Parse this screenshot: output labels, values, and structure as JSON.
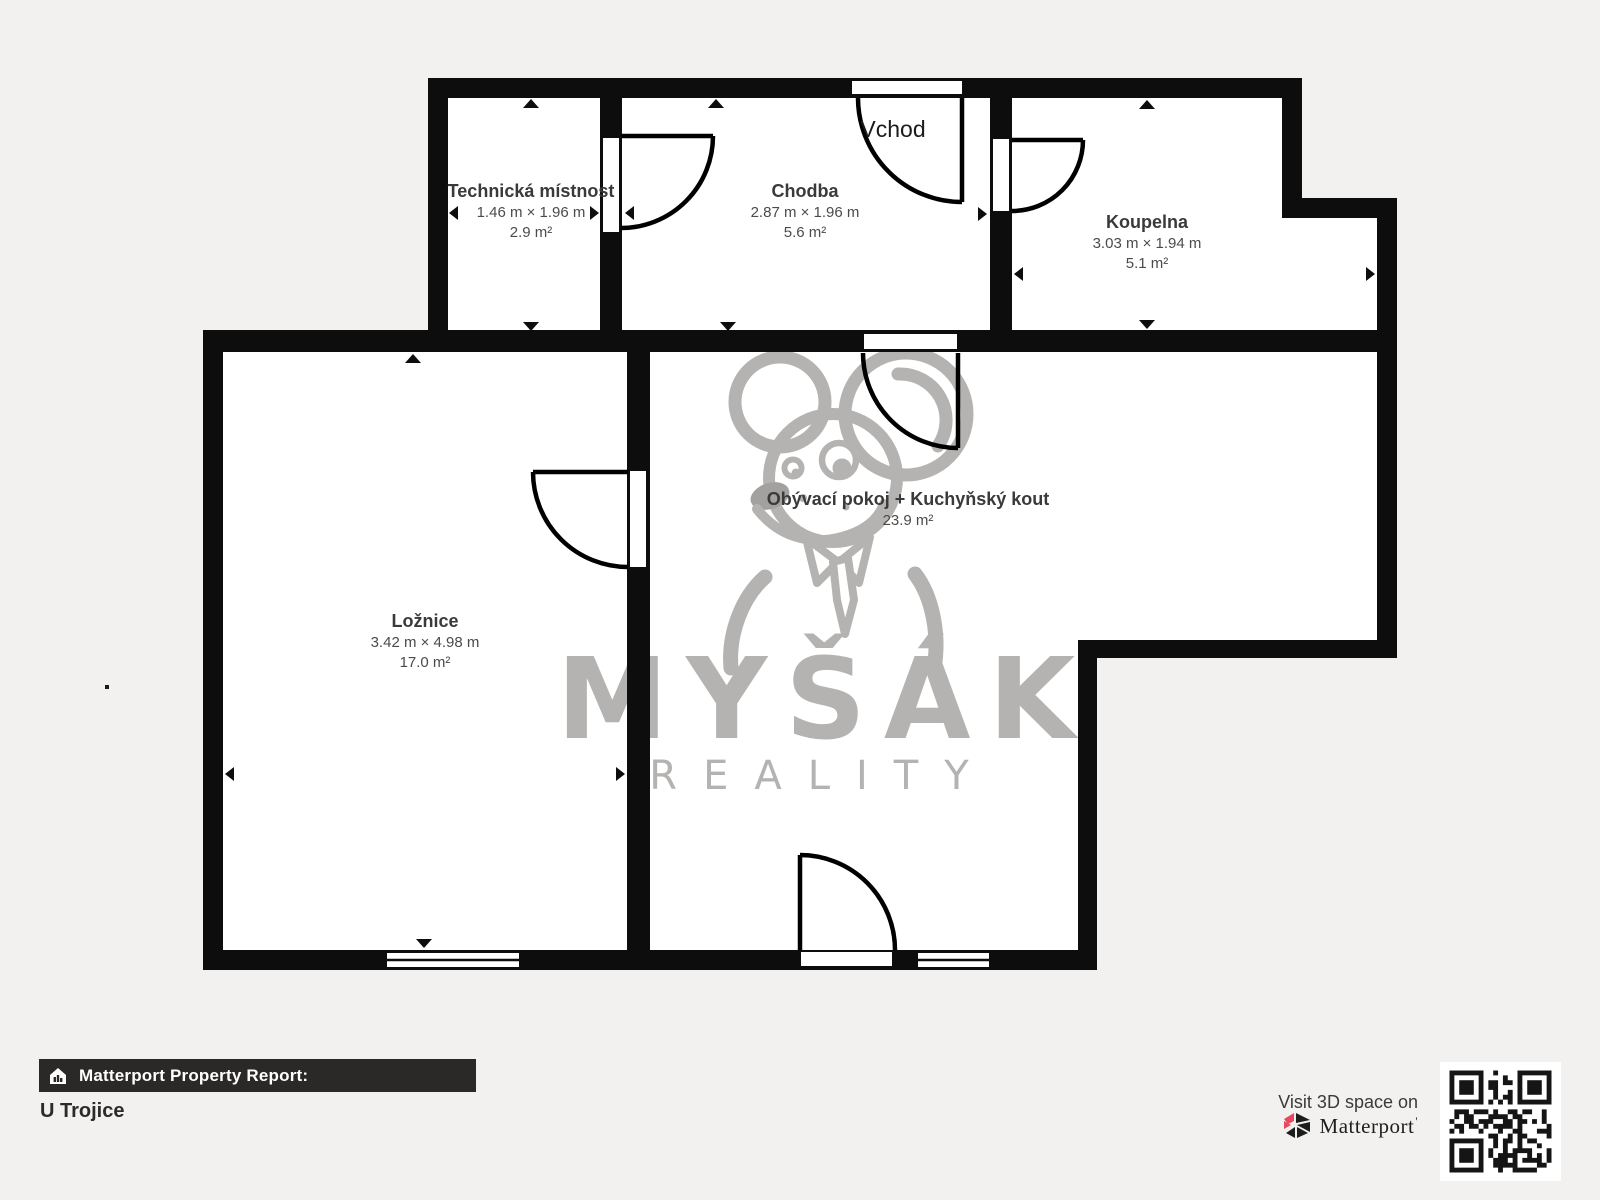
{
  "floorplan": {
    "entrance_label": "Vchod",
    "rooms": [
      {
        "name": "Technická místnost",
        "dimensions": "1.46 m × 1.96 m",
        "area": "2.9 m²"
      },
      {
        "name": "Chodba",
        "dimensions": "2.87 m × 1.96 m",
        "area": "5.6 m²"
      },
      {
        "name": "Koupelna",
        "dimensions": "3.03 m × 1.94 m",
        "area": "5.1 m²"
      },
      {
        "name": "Ložnice",
        "dimensions": "3.42 m × 4.98 m",
        "area": "17.0 m²"
      },
      {
        "name": "Obývací pokoj + Kuchyňský kout",
        "dimensions": "",
        "area": "23.9 m²"
      }
    ]
  },
  "watermark": {
    "brand": "MYŠÁK",
    "subtitle": "REALITY"
  },
  "footer": {
    "report_label": "Matterport Property Report:",
    "property_name": "U Trojice",
    "visit_text": "Visit 3D space on",
    "brand_name": "Matterport",
    "brand_mark": "'"
  },
  "colors": {
    "wall": "#0d0d0d",
    "background": "#f2f1ef",
    "room_fill": "#ffffff",
    "watermark_gray": "#b5b3b1",
    "report_bar": "#2b2928",
    "matterport_pink": "#e8495f"
  }
}
